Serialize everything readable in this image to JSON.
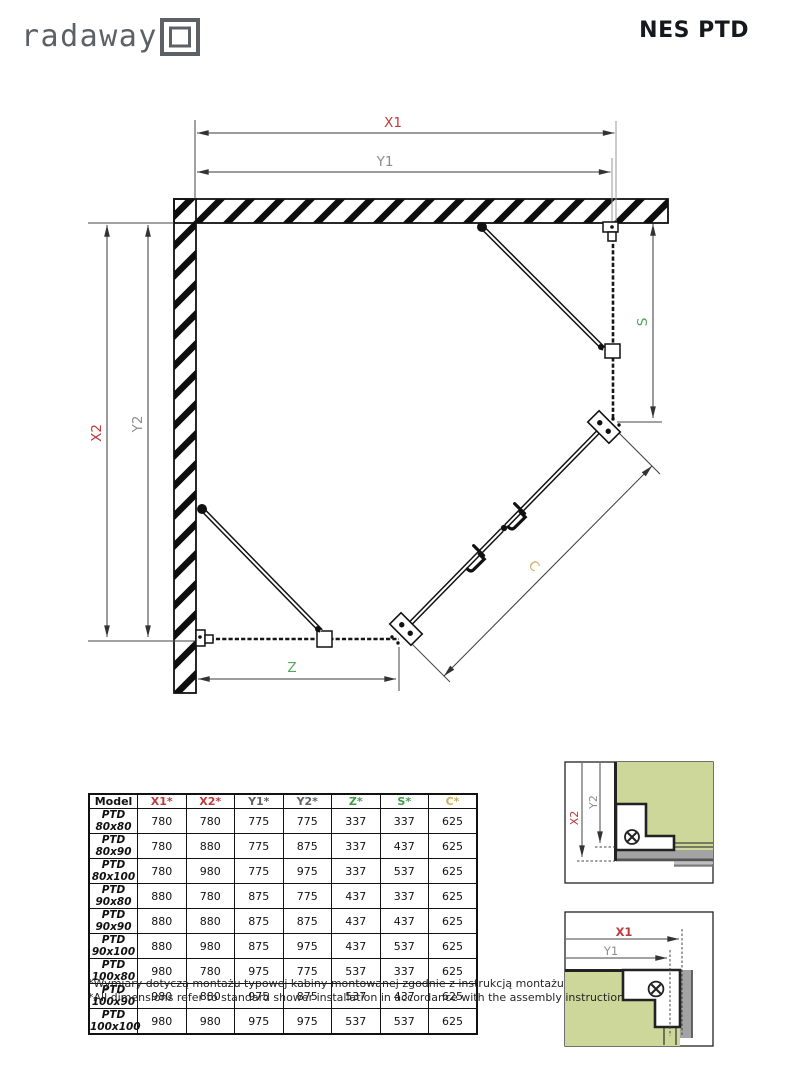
{
  "header": {
    "logo_text": "radaway",
    "title": "NES PTD"
  },
  "diagram": {
    "dim_labels": {
      "x1": "X1",
      "y1": "Y1",
      "x2": "X2",
      "y2": "Y2",
      "s": "S",
      "z": "Z",
      "c": "C"
    },
    "colors": {
      "x": "#c0393b",
      "y": "#8c8c8c",
      "zs": "#55a65a",
      "c": "#d2a96a",
      "line": "#1a1a1a",
      "detail_glass": "#cdd79a"
    }
  },
  "table": {
    "headers": [
      {
        "label": "Model",
        "color": "#111111"
      },
      {
        "label": "X1*",
        "color": "#c0393b"
      },
      {
        "label": "X2*",
        "color": "#c0393b"
      },
      {
        "label": "Y1*",
        "color": "#5f6368"
      },
      {
        "label": "Y2*",
        "color": "#5f6368"
      },
      {
        "label": "Z*",
        "color": "#3f9e49"
      },
      {
        "label": "S*",
        "color": "#3f9e49"
      },
      {
        "label": "C*",
        "color": "#c9b05f"
      }
    ],
    "rows": [
      {
        "model": "PTD 80x80",
        "values": [
          "780",
          "780",
          "775",
          "775",
          "337",
          "337",
          "625"
        ]
      },
      {
        "model": "PTD 80x90",
        "values": [
          "780",
          "880",
          "775",
          "875",
          "337",
          "437",
          "625"
        ]
      },
      {
        "model": "PTD 80x100",
        "values": [
          "780",
          "980",
          "775",
          "975",
          "337",
          "537",
          "625"
        ]
      },
      {
        "model": "PTD 90x80",
        "values": [
          "880",
          "780",
          "875",
          "775",
          "437",
          "337",
          "625"
        ]
      },
      {
        "model": "PTD 90x90",
        "values": [
          "880",
          "880",
          "875",
          "875",
          "437",
          "437",
          "625"
        ]
      },
      {
        "model": "PTD 90x100",
        "values": [
          "880",
          "980",
          "875",
          "975",
          "437",
          "537",
          "625"
        ]
      },
      {
        "model": "PTD 100x80",
        "values": [
          "980",
          "780",
          "975",
          "775",
          "537",
          "337",
          "625"
        ]
      },
      {
        "model": "PTD 100x90",
        "values": [
          "980",
          "880",
          "975",
          "875",
          "537",
          "437",
          "625"
        ]
      },
      {
        "model": "PTD 100x100",
        "values": [
          "980",
          "980",
          "975",
          "975",
          "537",
          "537",
          "625"
        ]
      }
    ]
  },
  "footnotes": {
    "pl": "*Wymiary dotyczą montażu typowej kabiny montowanej zgodnie z instrukcją montażu",
    "en": "*All dimensions refer to standard shower installation in accordance with the assembly instruction"
  }
}
